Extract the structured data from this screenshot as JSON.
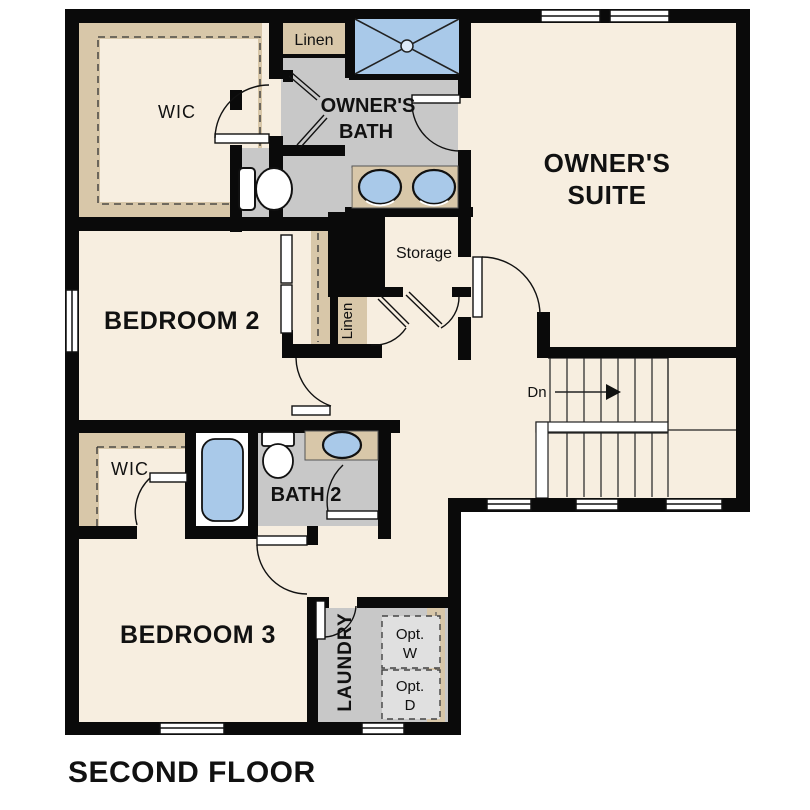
{
  "title": "SECOND FLOOR",
  "colors": {
    "floor_cream": "#f7eee0",
    "closet_tan": "#d8c7a9",
    "bath_floor_gray": "#c8c8c8",
    "appliance_gray": "#e0e0e0",
    "fixture_blue": "#a9c9e9",
    "wall_black": "#0a0a0a",
    "white": "#ffffff"
  },
  "rooms": {
    "owners_suite": {
      "line1": "OWNER'S",
      "line2": "SUITE"
    },
    "owners_bath": {
      "line1": "OWNER'S",
      "line2": "BATH"
    },
    "wic_owners": {
      "label": "WIC"
    },
    "linen_top": {
      "label": "Linen"
    },
    "bedroom_2": {
      "label": "BEDROOM 2"
    },
    "storage": {
      "label": "Storage"
    },
    "linen_hall": {
      "label": "Linen"
    },
    "stairs": {
      "direction_label": "Dn"
    },
    "wic_bedroom3": {
      "label": "WIC"
    },
    "bath_2": {
      "label": "BATH 2"
    },
    "bedroom_3": {
      "label": "BEDROOM 3"
    },
    "laundry": {
      "label": "LAUNDRY"
    },
    "washer_opt": {
      "line1": "Opt.",
      "line2": "W"
    },
    "dryer_opt": {
      "line1": "Opt.",
      "line2": "D"
    }
  }
}
